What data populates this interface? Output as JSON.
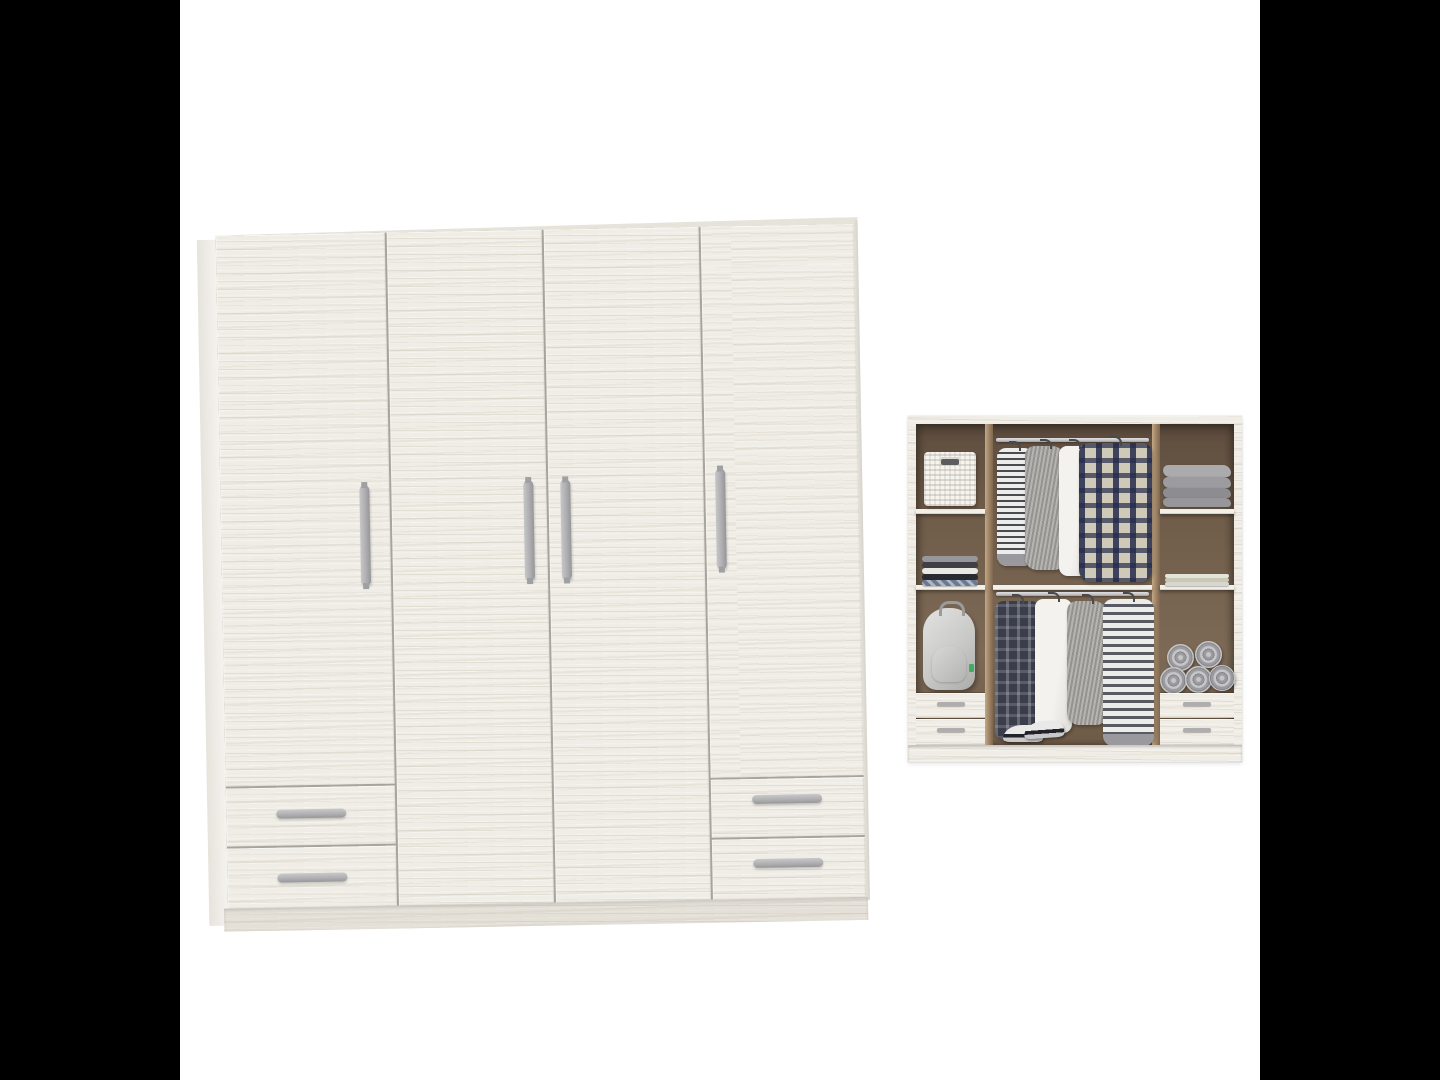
{
  "scene": {
    "type": "furniture product render, no text",
    "views": [
      "closed wardrobe front view (left, large)",
      "open wardrobe interior view (right, small)"
    ],
    "letterbox": "black vertical bars left and right of a square white image area"
  },
  "colors": {
    "letterbox": "#000000",
    "canvas": "#ffffff",
    "wood-base": "#f0ede6",
    "panel-gap": "#a8a49b",
    "top-face": "#e6e3da",
    "handle": "#aeaeb1",
    "interior-back": "#6f5c49",
    "interior-floor": "#7d6a56",
    "partition": "#a38869",
    "shelf": "#f2f0ea",
    "rod": "#c7c7ca",
    "basket": "#f5f4f0",
    "backpack": "#c9c9c7",
    "plaid-cream": "#cfc9b8",
    "stripe-dark": "#4a4a52",
    "stripe-light": "#ececea",
    "sweater": "#9d9b97",
    "shirt": "#f3f2ef",
    "towel": "#9b9b9f",
    "sneaker": "#e9e9e7",
    "sneaker-band": "#22222a"
  },
  "closed_wardrobe": {
    "finish": "white-washed wood",
    "door_count": 4,
    "drawer_count": 4,
    "layout": "two narrow outer doors above two drawers each, two full-height center doors",
    "door_handles": "vertical grey bar handles",
    "drawer_handles": "horizontal grey bar handles"
  },
  "open_wardrobe": {
    "interior": "brown back panel, white shelves and frame",
    "left_column": {
      "items": [
        "white wicker basket",
        "stack of folded shirts (grey, dark, white, navy, blue pattern)",
        "grey backpack with green tag"
      ],
      "drawers": 2
    },
    "center_section": {
      "rods": 2,
      "top_rod_garments": [
        "striped long-sleeve top",
        "grey sweater",
        "white shirt",
        "navy plaid shirt"
      ],
      "bottom_rod_garments": [
        "dark plaid long shirt",
        "white shirt",
        "grey cardigan",
        "striped dress"
      ],
      "floor_items": [
        "pair of white sneakers with black band"
      ]
    },
    "right_column": {
      "items": [
        "stack of folded grey blankets",
        "folded white and sage linens",
        "five rolled grey towels"
      ],
      "drawers": 2
    }
  }
}
